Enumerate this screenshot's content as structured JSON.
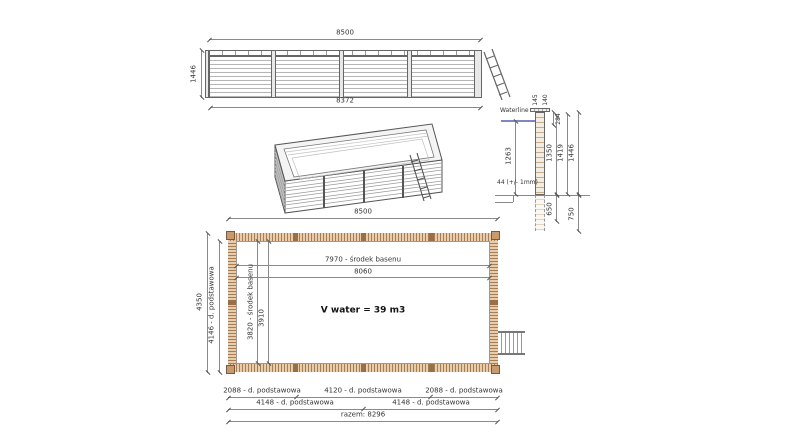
{
  "drawing": {
    "elevation": {
      "dim_top": "8500",
      "dim_height": "1446",
      "dim_bottom": "8372"
    },
    "section": {
      "waterline": "Waterline",
      "thickness_note": "44 (+/- 1mm)",
      "top_dims": [
        "145",
        "140"
      ],
      "dim_coping": "284",
      "dim_water_depth": "1263",
      "dim_wall_inner": "1350",
      "dim_wall_mid": "1419",
      "dim_wall_total": "1446",
      "dim_buried": "650",
      "dim_base": "750"
    },
    "plan": {
      "dim_top": "8500",
      "dim_center_length": "7970 - środek basenu",
      "dim_inner_length": "8060",
      "dim_width_outer": "4350",
      "dim_width_base": "4146 - d. podstawowa",
      "dim_center_width": "3820 - środek basenu",
      "dim_inner_width": "3910",
      "volume": "V water = 39 m3",
      "row1": [
        "2088 - d. podstawowa",
        "4120 - d. podstawowa",
        "2088 - d. podstawowa"
      ],
      "row2": [
        "4148 - d. podstawowa",
        "4148 - d. podstawowa"
      ],
      "total": "razem: 8296"
    },
    "colors": {
      "waterline_blue": "#7e86c4",
      "wood_light": "#e6cdae",
      "wood_dark": "#aa7c52",
      "line_gray": "#8a8a8a"
    }
  }
}
